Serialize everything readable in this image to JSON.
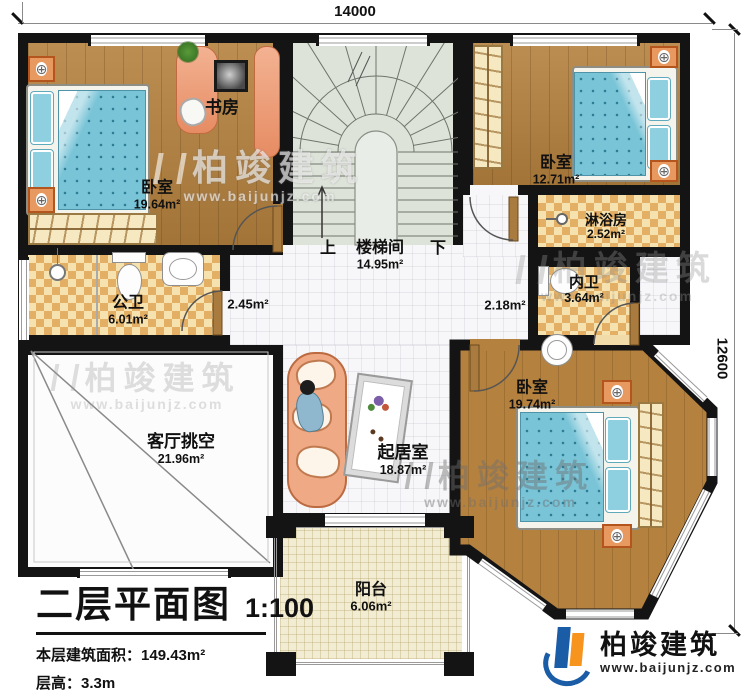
{
  "dimensions": {
    "top": "14000",
    "right": "12600"
  },
  "rooms": {
    "study": {
      "name": "书房"
    },
    "bedroom1": {
      "name": "卧室",
      "area": "19.64m²"
    },
    "bedroom2": {
      "name": "卧室",
      "area": "12.71m²"
    },
    "stairwell": {
      "up": "上",
      "name": "楼梯间",
      "area": "14.95m²",
      "down": "下"
    },
    "shower": {
      "name": "淋浴房",
      "area": "2.52m²"
    },
    "inner_bath": {
      "name": "内卫",
      "area": "3.64m²"
    },
    "public_bath": {
      "name": "公卫",
      "area": "6.01m²"
    },
    "hall_left": {
      "area": "2.45m²"
    },
    "hall_right": {
      "area": "2.18m²"
    },
    "void": {
      "name": "客厅挑空",
      "area": "21.96m²"
    },
    "living": {
      "name": "起居室",
      "area": "18.87m²"
    },
    "bedroom3": {
      "name": "卧室",
      "area": "19.74m²"
    },
    "balcony": {
      "name": "阳台",
      "area": "6.06m²"
    }
  },
  "title": {
    "plan": "二层平面图",
    "scale": "1:100",
    "area_label": "本层建筑面积：",
    "area_value": "149.43m²",
    "height_label": "层高：",
    "height_value": "3.3m"
  },
  "branding": {
    "logo_name": "柏竣建筑",
    "logo_url": "www.baijunjz.com",
    "watermark_name": "柏竣建筑",
    "watermark_url": "www.baijunjz.com"
  },
  "palette": {
    "wall": "#141414",
    "wood_floor": "#b5813e",
    "bath_tile_dark": "#e3af64",
    "bath_tile_light": "#f6e2ae",
    "stair_floor": "#dde3d8",
    "bed_blue": "#79c4d7",
    "sofa_salmon": "#efa985",
    "logo_blue": "#1b5ca6",
    "logo_orange": "#f7941e"
  }
}
